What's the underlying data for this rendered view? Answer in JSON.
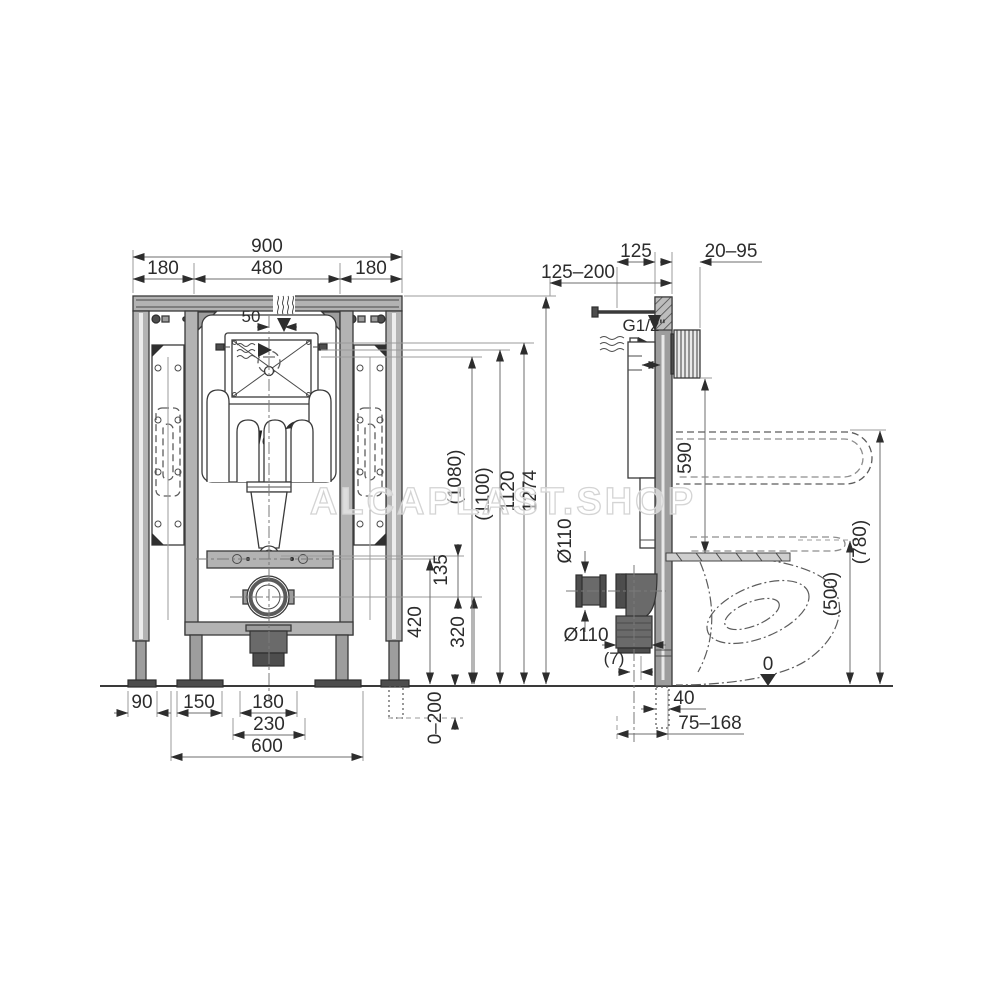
{
  "watermark": "ALCAPLAST.SHOP",
  "logo": "Alca",
  "front": {
    "total_width": "900",
    "width_left": "180",
    "width_center": "480",
    "width_right": "180",
    "inlet_offset": "50",
    "h_total": "1274",
    "h_frame": "1120",
    "h_opt1": "(1100)",
    "h_opt2": "(1080)",
    "h_bracket": "420",
    "h_drain": "320",
    "spacing_135": "135",
    "foot_adjust": "0–200",
    "b90": "90",
    "b150": "150",
    "b180": "180",
    "b230": "230",
    "b600": "600"
  },
  "side": {
    "rod_range": "125–200",
    "depth_125": "125",
    "plate_range": "20–95",
    "water_conn": "G1/2\"",
    "h590": "590",
    "dia_sleeve": "Ø110",
    "dia_elbow": "Ø110",
    "offset7": "(7)",
    "floor_pipe": "40",
    "drain_range": "75–168",
    "seat_h": "(500)",
    "bowl_h": "(780)",
    "floor_zero": "0"
  }
}
